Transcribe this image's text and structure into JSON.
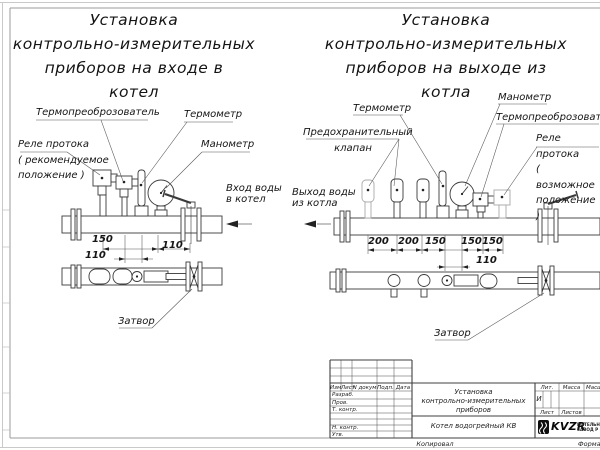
{
  "colors": {
    "line": "#3a3a3a",
    "ghost": "#a9a9a9",
    "frame": "#9b9b9b"
  },
  "left_diagram": {
    "title": "Установка\nконтрольно-измерительных\nприборов на входе в\nкотел",
    "labels": {
      "thermotransducer": "Термопреоброзователь",
      "thermometer": "Термометр",
      "flow_relay": "Реле протока\n( рекомендуемое\nположение )",
      "manometer": "Манометр",
      "flow_note": "Вход воды\nв котел",
      "valve": "Затвор"
    },
    "dimensions": [
      "150",
      "110",
      "110"
    ]
  },
  "right_diagram": {
    "title": "Установка\nконтрольно-измерительных\nприборов на выходе из\nкотла",
    "labels": {
      "thermometer": "Термометр",
      "manometer": "Манометр",
      "thermotransducer": "Термопреоброзователь",
      "safety_valve": "Предохранительный\nклапан",
      "flow_relay": "Реле протока\n( возможное\nположение )",
      "flow_note": "Выход воды\nиз котла",
      "valve": "Затвор"
    },
    "dimensions": [
      "200",
      "200",
      "150",
      "150",
      "150",
      "110"
    ]
  },
  "title_block": {
    "header_cols": [
      "Изм",
      "Лист",
      "N докум",
      "Подп.",
      "Дата"
    ],
    "rows": [
      "Разраб.",
      "Пров.",
      "Т. контр.",
      "Н. контр.",
      "Утв."
    ],
    "doc_title": "Установка\nконтрольно-измерительных\nприборов",
    "doc_subtitle": "Котел водогрейный КВ",
    "lit_label": "Лит.",
    "lit_value": "И",
    "mass_label": "Масса",
    "scale_label": "Масштаб",
    "sheet_label": "Лист",
    "sheets_label": "Листов",
    "logo_text": "KVZR",
    "logo_caption": "КОТЕЛЬНЫ\nЗАВОД Р",
    "copied": "Копировал",
    "format": "Формат"
  }
}
